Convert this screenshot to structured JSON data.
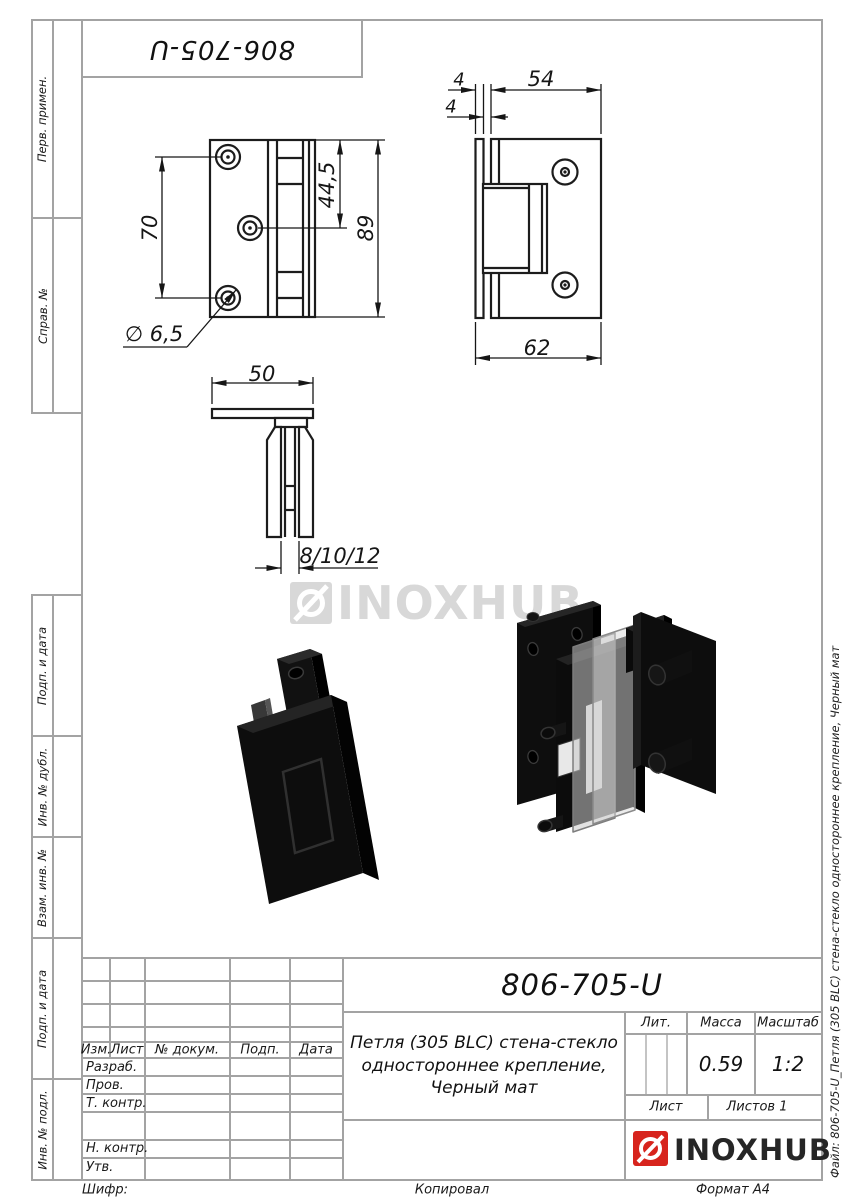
{
  "sheet": {
    "top_designation": "806-705-U",
    "cipher_label": "Шифр:",
    "copied_label": "Копировал",
    "format_label": "Формат А4",
    "file_annotation": "Файл: 806-705-U_Петля (305 BLC) стена-стекло одностороннее крепление, Черный мат"
  },
  "margin_labels": {
    "perv_primen": "Перв. примен.",
    "sprav_no": "Справ. №",
    "podp_data_top": "Подп. и дата",
    "inv_dubl": "Инв. № дубл.",
    "vzam_inv": "Взам. инв. №",
    "podp_data_bottom": "Подп. и дата",
    "inv_podl": "Инв. № подл."
  },
  "watermark": {
    "brand": "INOXHUB"
  },
  "dimensions": {
    "front_hole_span": "70",
    "front_mid_hole": "44,5",
    "front_total_height": "89",
    "hole_diameter": "∅ 6,5",
    "side_plate_thickness": "4",
    "side_body_width": "54",
    "side_gap": "4",
    "side_total_width": "62",
    "top_plate_width": "50",
    "glass_thickness": "8/10/12"
  },
  "title_block": {
    "designation": "806-705-U",
    "description": "Петля (305 BLC) стена-стекло\nодностороннее крепление,\nЧерный мат",
    "col_izm": "Изм.",
    "col_list": "Лист",
    "col_dokum": "№ докум.",
    "col_podp": "Подп.",
    "col_data": "Дата",
    "row_razrab": "Разраб.",
    "row_prov": "Пров.",
    "row_tkontr": "Т. контр.",
    "row_nkontr": "Н. контр.",
    "row_utv": "Утв.",
    "lit_label": "Лит.",
    "massa_label": "Масса",
    "masshtab_label": "Масштаб",
    "massa_value": "0.59",
    "masshtab_value": "1:2",
    "list_label": "Лист",
    "listov_label": "Листов 1",
    "brand": "INOXHUB",
    "accent_red": "#d7241d",
    "line_gray": "#a3a3a3"
  }
}
